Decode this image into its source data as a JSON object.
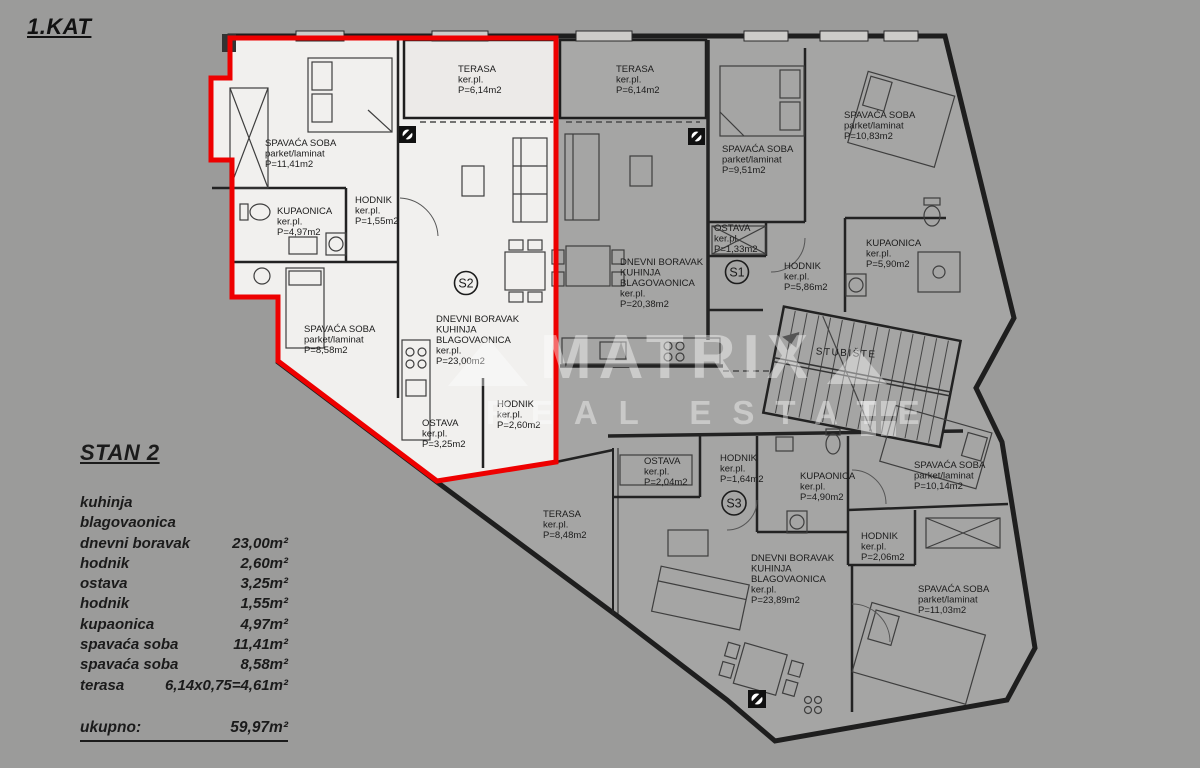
{
  "page": {
    "floor_title": "1.KAT"
  },
  "colors": {
    "background": "#9b9b9a",
    "building_fill": "#a5a5a4",
    "highlight_unit_fill": "#f1f0ee",
    "highlight_outline": "#ee0000",
    "wall": "#1e1e1e",
    "watermark": "#ffffff"
  },
  "watermark": {
    "brand": "MATRIX",
    "tagline": "REAL ESTATE"
  },
  "plan": {
    "stairwell_label": "STUBIŠTE"
  },
  "units": {
    "s2": {
      "badge": "S2",
      "rooms": [
        {
          "name": "TERASA",
          "finish": "ker.pl.",
          "area": "P=6,14m2"
        },
        {
          "name": "SPAVAĆA SOBA",
          "finish": "parket/laminat",
          "area": "P=11,41m2"
        },
        {
          "name": "KUPAONICA",
          "finish": "ker.pl.",
          "area": "P=4,97m2"
        },
        {
          "name": "HODNIK",
          "finish": "ker.pl.",
          "area": "P=1,55m2"
        },
        {
          "name": "DNEVNI BORAVAK",
          "name2": "KUHINJA",
          "name3": "BLAGOVAONICA",
          "finish": "ker.pl.",
          "area": "P=23,00m2"
        },
        {
          "name": "SPAVAĆA SOBA",
          "finish": "parket/laminat",
          "area": "P=8,58m2"
        },
        {
          "name": "OSTAVA",
          "finish": "ker.pl.",
          "area": "P=3,25m2"
        },
        {
          "name": "HODNIK",
          "finish": "ker.pl.",
          "area": "P=2,60m2"
        }
      ]
    },
    "s1": {
      "badge": "S1",
      "rooms": [
        {
          "name": "TERASA",
          "finish": "ker.pl.",
          "area": "P=6,14m2"
        },
        {
          "name": "SPAVAĆA SOBA",
          "finish": "parket/laminat",
          "area": "P=9,51m2"
        },
        {
          "name": "SPAVAĆA SOBA",
          "finish": "parket/laminat",
          "area": "P=10,83m2"
        },
        {
          "name": "OSTAVA",
          "finish": "ker.pl.",
          "area": "P=1,33m2"
        },
        {
          "name": "DNEVNI BORAVAK",
          "name2": "KUHINJA",
          "name3": "BLAGOVAONICA",
          "finish": "ker.pl.",
          "area": "P=20,38m2"
        },
        {
          "name": "HODNIK",
          "finish": "ker.pl.",
          "area": "P=5,86m2"
        },
        {
          "name": "KUPAONICA",
          "finish": "ker.pl.",
          "area": "P=5,90m2"
        }
      ]
    },
    "s3": {
      "badge": "S3",
      "rooms": [
        {
          "name": "OSTAVA",
          "finish": "ker.pl.",
          "area": "P=2,04m2"
        },
        {
          "name": "HODNIK",
          "finish": "ker.pl.",
          "area": "P=1,64m2"
        },
        {
          "name": "KUPAONICA",
          "finish": "ker.pl.",
          "area": "P=4,90m2"
        },
        {
          "name": "TERASA",
          "finish": "ker.pl.",
          "area": "P=8,48m2"
        },
        {
          "name": "DNEVNI BORAVAK",
          "name2": "KUHINJA",
          "name3": "BLAGOVAONICA",
          "finish": "ker.pl.",
          "area": "P=23,89m2"
        },
        {
          "name": "HODNIK",
          "finish": "ker.pl.",
          "area": "P=2,06m2"
        },
        {
          "name": "SPAVAĆA SOBA",
          "finish": "parket/laminat",
          "area": "P=10,14m2"
        },
        {
          "name": "SPAVAĆA SOBA",
          "finish": "parket/laminat",
          "area": "P=11,03m2"
        }
      ]
    }
  },
  "summary": {
    "heading": "STAN 2",
    "rows": [
      {
        "label": "kuhinja",
        "value": ""
      },
      {
        "label": "blagovaonica",
        "value": ""
      },
      {
        "label": "dnevni boravak",
        "value": "23,00m²"
      },
      {
        "label": "hodnik",
        "value": "2,60m²"
      },
      {
        "label": "ostava",
        "value": "3,25m²"
      },
      {
        "label": "hodnik",
        "value": "1,55m²"
      },
      {
        "label": "kupaonica",
        "value": "4,97m²"
      },
      {
        "label": "spavaća soba",
        "value": "11,41m²"
      },
      {
        "label": "spavaća soba",
        "value": "8,58m²"
      },
      {
        "label": "terasa",
        "value": "6,14x0,75=4,61m²"
      }
    ],
    "total_label": "ukupno:",
    "total_value": "59,97m²"
  }
}
